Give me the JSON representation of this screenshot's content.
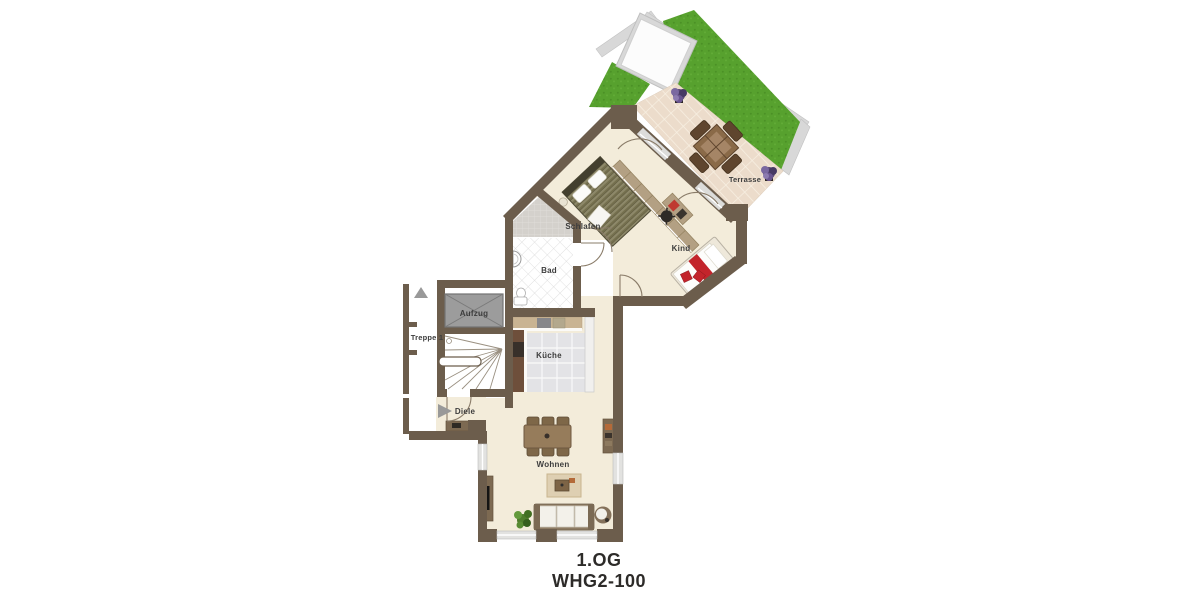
{
  "title": {
    "line1": "1.OG",
    "line2": "WHG2-100"
  },
  "labels": {
    "terrasse": "Terrasse",
    "schlafen": "Schlafen",
    "kind": "Kind",
    "bad": "Bad",
    "aufzug": "Aufzug",
    "treppe": "Treppe 1",
    "kueche": "Küche",
    "diele": "Diele",
    "wohnen": "Wohnen"
  },
  "palette": {
    "wall": "#6c5d4c",
    "floor": "#f3ecda",
    "grass": "#57a12e",
    "terrace_tile": "#ecdccb",
    "roof_band": "#d8d8d8",
    "kitchen_tile": "#e3e3e6",
    "accent_red": "#c3242b",
    "wood": "#967c5b",
    "elevator_gray": "#9c9c9c"
  }
}
